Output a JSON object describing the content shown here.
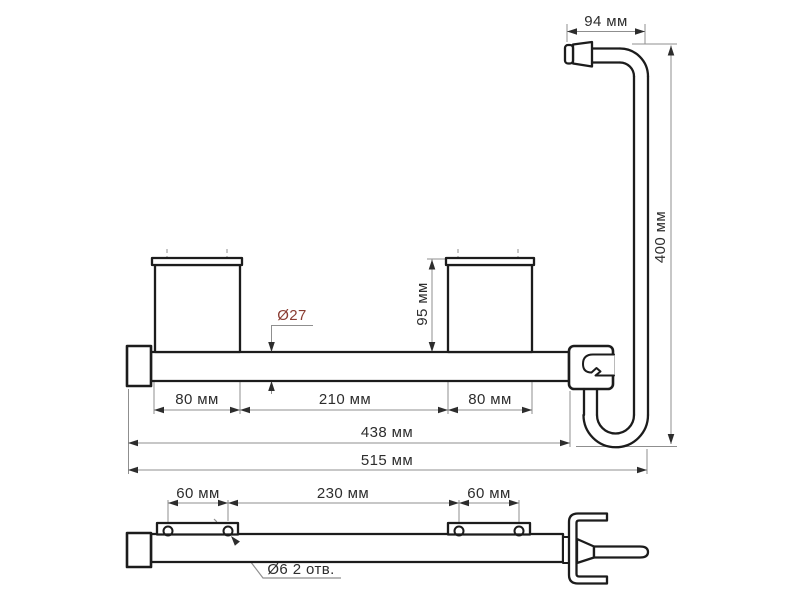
{
  "document": {
    "type": "technical-drawing",
    "background": "#ffffff",
    "units": "мм"
  },
  "colors": {
    "outline": "#1c1c1c",
    "dim": "#8f8f8f",
    "text": "#2d2d2d",
    "accent": "#8a3c32"
  },
  "views": {
    "side_view": {
      "dims": {
        "handle_length": "94 мм",
        "overall_height": "400 мм",
        "bracket_height": "95 мм",
        "tube_diameter": "Ø27",
        "left_bracket_offset": "80 мм",
        "between_brackets": "210 мм",
        "right_bracket_offset": "80 мм",
        "bar_length": "438 мм",
        "overall_length": "515 мм"
      }
    },
    "plan_view": {
      "dims": {
        "left_hole_spacing": "60 мм",
        "center_hole_spacing": "230 мм",
        "right_hole_spacing": "60 мм",
        "hole_callout": "Ø6 2 отв."
      }
    }
  }
}
